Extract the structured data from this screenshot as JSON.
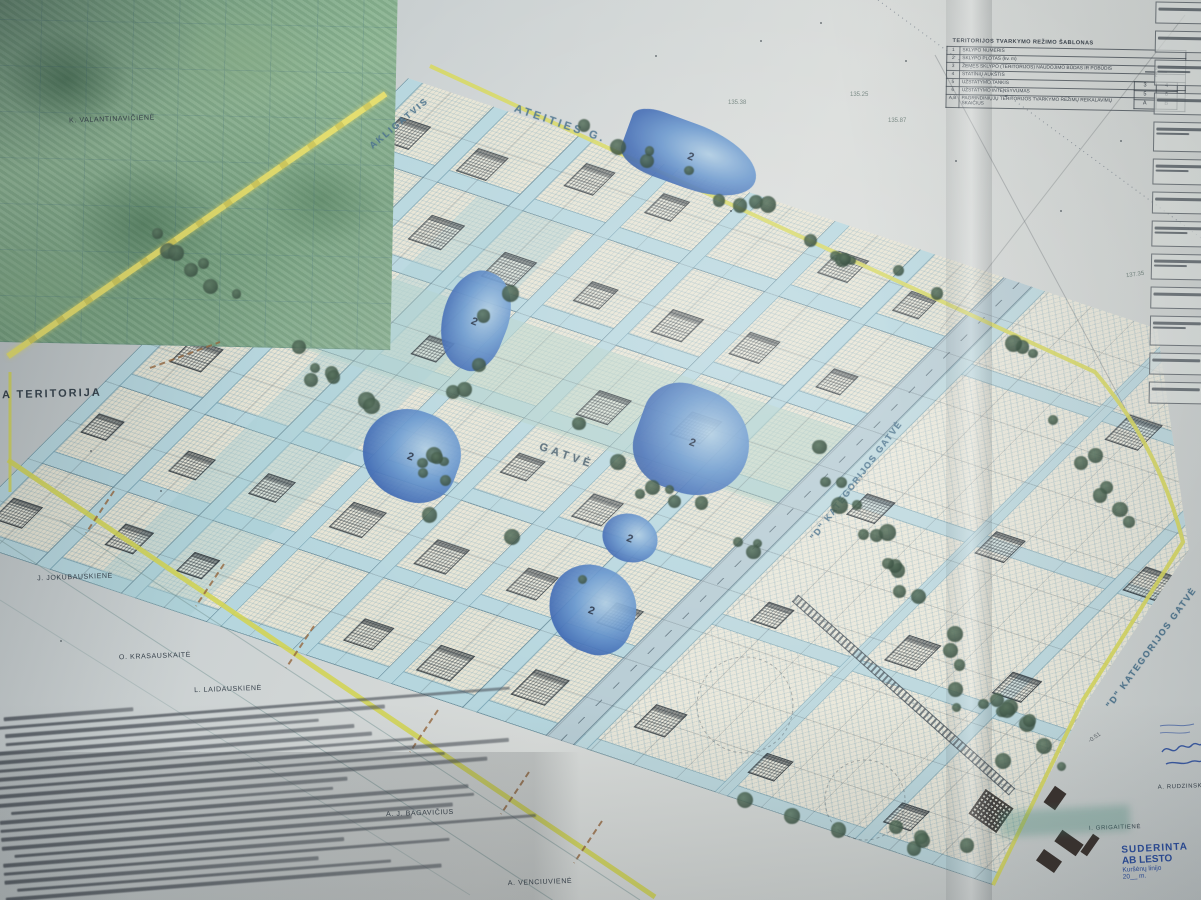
{
  "legend": {
    "title": "TERITORIJOS TVARKYMO REŽIMO ŠABLONAS",
    "rows": [
      {
        "num": "1",
        "label": "SKLYPO NUMERIS"
      },
      {
        "num": "2",
        "label": "SKLYPO PLOTAS (kv. m)"
      },
      {
        "num": "3",
        "label": "ŽEMĖS SKLYPO (TERITORIJOS) NAUDOJIMO BŪDAS IR POBŪDIS"
      },
      {
        "num": "4",
        "label": "STATINIŲ AUKŠTIS"
      },
      {
        "num": "5",
        "label": "UŽSTATYMO TANKIS"
      },
      {
        "num": "6",
        "label": "UŽSTATYMO INTENSYVUMAS"
      },
      {
        "num": "A,B",
        "label": "PAGRINDINIŲJŲ TERITORIJOS TVARKYMO REŽIMŲ REIKALAVIMŲ SKAIČIUS"
      }
    ],
    "diagram": {
      "top": "1",
      "bottom": "2",
      "grid": [
        [
          "3",
          "4"
        ],
        [
          "5",
          "6"
        ],
        [
          "A",
          "B"
        ]
      ]
    }
  },
  "streets": {
    "akligatvis": "AKLIGATVIS",
    "ateities": "ATEITIES G.",
    "gatve": "GATVĖ",
    "d_kat_1": "\"D\" KATEGORIJOS GATVĖ",
    "d_kat_2": "\"D\" KATEGORIJOS GATVĖ"
  },
  "owners": [
    "K. VALANTINAVIČIENĖ",
    "J. JOKUBAUSKIENĖ",
    "O. KRASAUSKAITĖ",
    "L. LAIDAUSKIENĖ",
    "A. J. BAGAVIČIUS",
    "A. VENCIUVIENĖ",
    "I. GRIGAITIENĖ",
    "A. RUDZINSK"
  ],
  "territory_label": "A TERITORIJA",
  "pond_label": "2",
  "elevations": [
    "135.38",
    "135.25",
    "135.87",
    "137.35"
  ],
  "cable_label": "-0.51",
  "approval_stamp": {
    "line1": "SUDERINTA",
    "line2": "AB LESTO",
    "line3": "Kuršėnų linijo",
    "line4": "20__ m."
  },
  "colors": {
    "boundary_yellow": "#d6d75e",
    "street_blue": "#b6d6de",
    "pond_blue": "#3562b0",
    "tree_green": "#49604f",
    "stamp_ink_blue": "#2b4ea0"
  }
}
